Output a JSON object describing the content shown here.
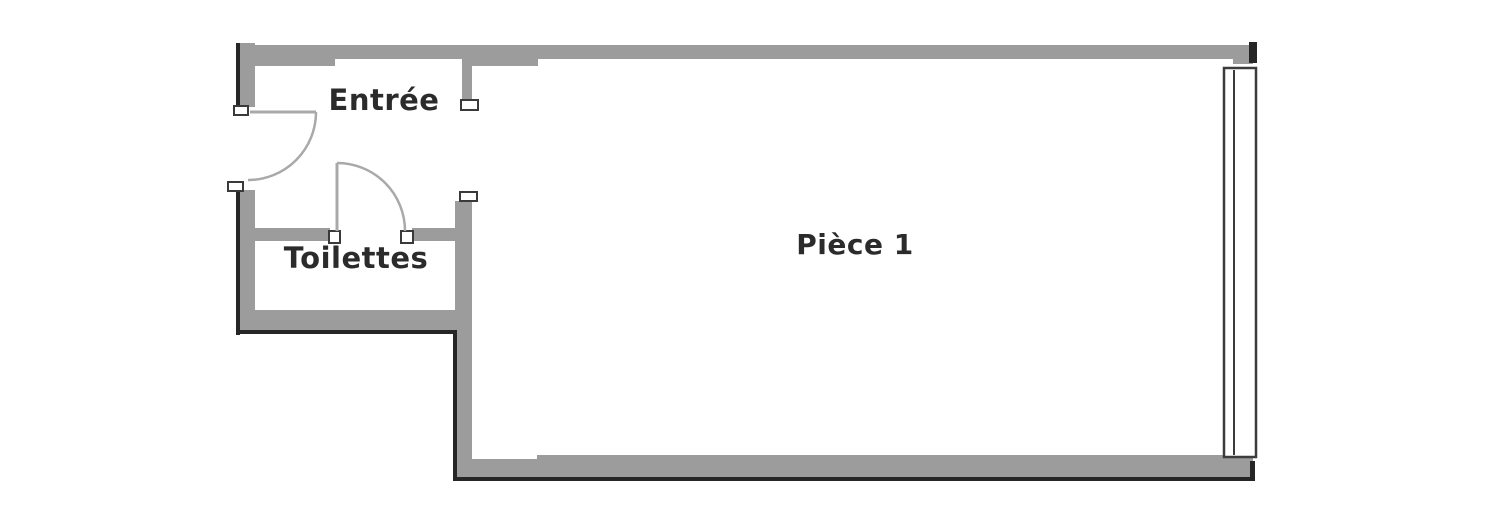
{
  "plan": {
    "rooms": {
      "entree": {
        "label": "Entrée"
      },
      "toilettes": {
        "label": "Toilettes"
      },
      "piece_1": {
        "label": "Pièce 1"
      }
    },
    "colors": {
      "wall": "#9c9c9c",
      "outline": "#262626",
      "door_line": "#a9a9a9",
      "text": "#2b2b2b",
      "background": "#ffffff"
    }
  }
}
